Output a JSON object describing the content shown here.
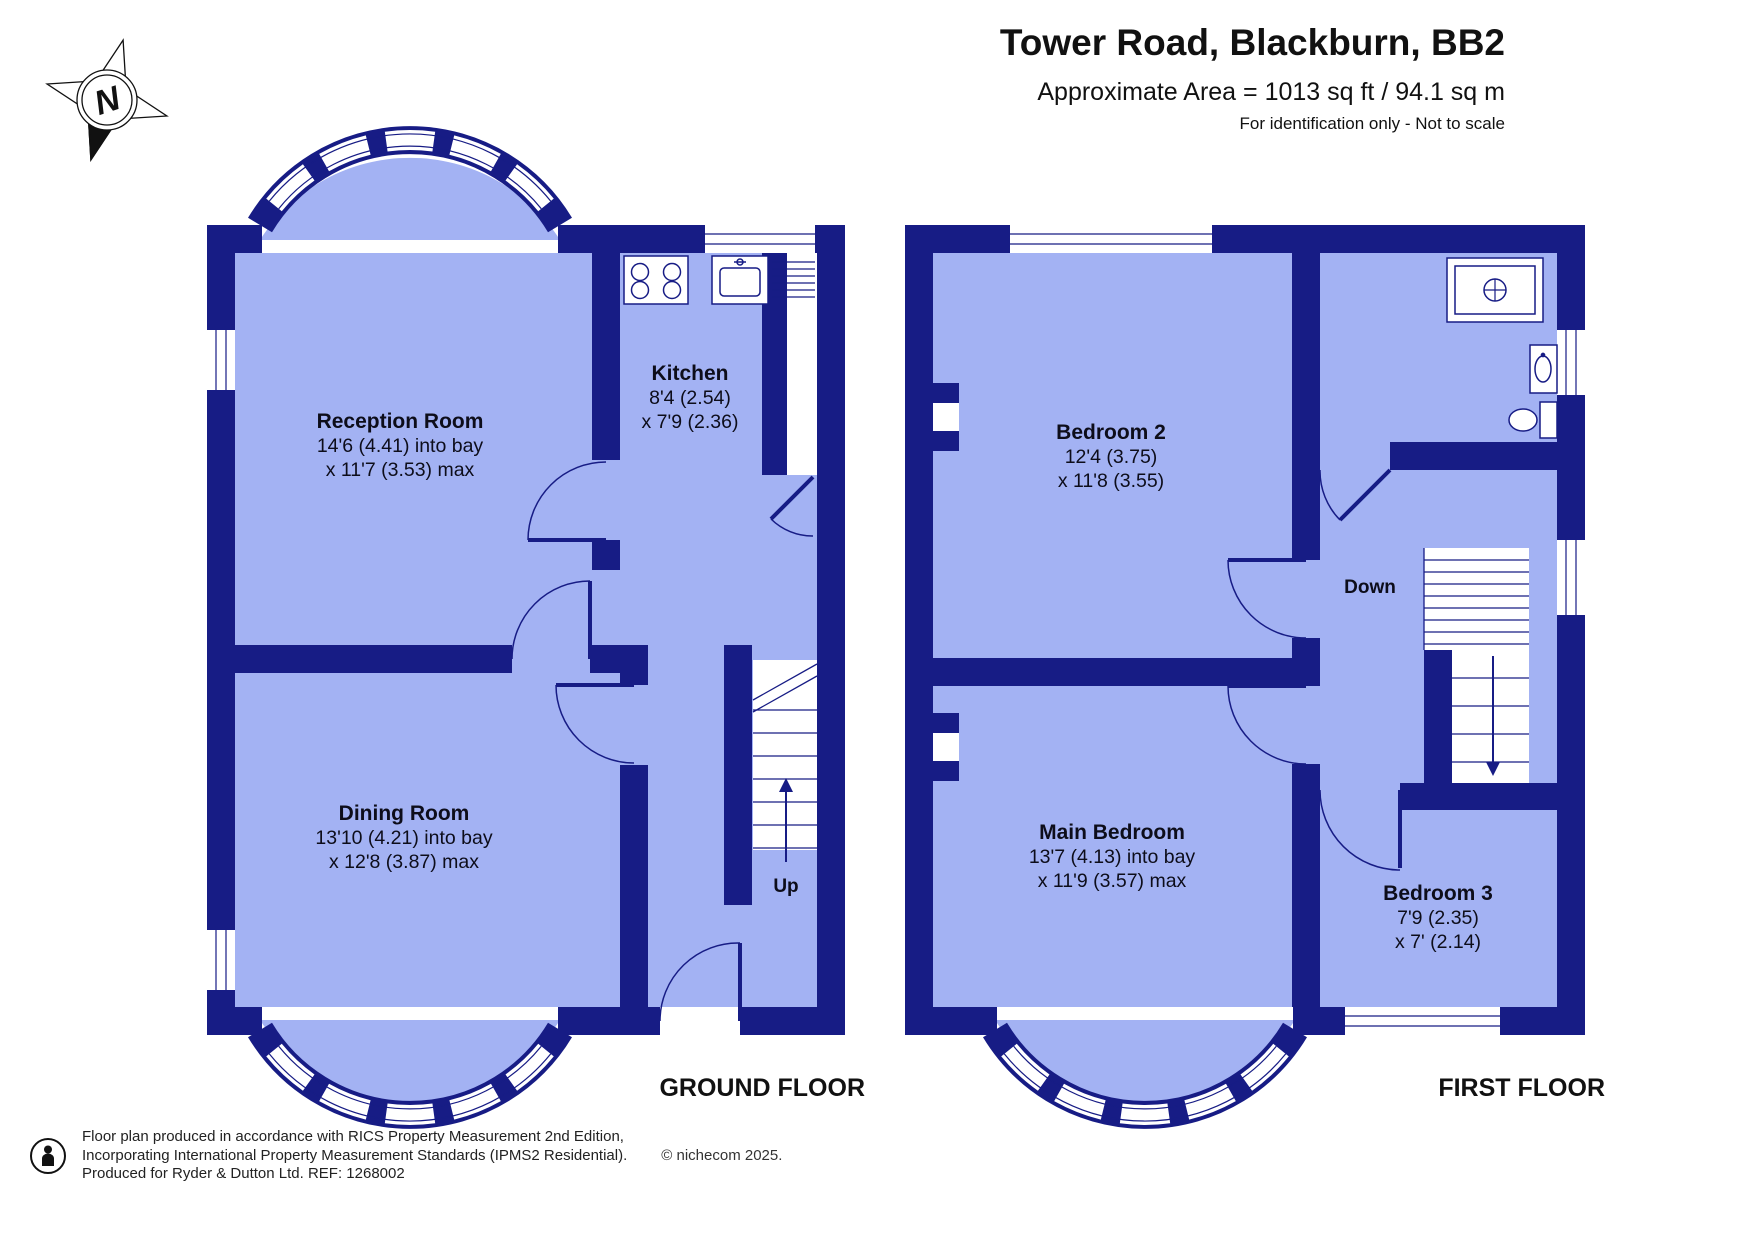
{
  "header": {
    "title": "Tower Road, Blackburn, BB2",
    "area": "Approximate Area = 1013 sq ft / 94.1 sq m",
    "note": "For identification only - Not to scale"
  },
  "compass": {
    "label": "N"
  },
  "colors": {
    "wall": "#171C85",
    "floor": "#A3B2F3",
    "line": "#171C85",
    "text": "#111111"
  },
  "ground_floor": {
    "label": "GROUND FLOOR",
    "stairs_label": "Up",
    "rooms": {
      "reception": {
        "name": "Reception Room",
        "dim1": "14'6 (4.41) into bay",
        "dim2": "x 11'7 (3.53) max"
      },
      "kitchen": {
        "name": "Kitchen",
        "dim1": "8'4 (2.54)",
        "dim2": "x 7'9 (2.36)"
      },
      "dining": {
        "name": "Dining Room",
        "dim1": "13'10 (4.21) into bay",
        "dim2": "x 12'8 (3.87) max"
      }
    }
  },
  "first_floor": {
    "label": "FIRST FLOOR",
    "stairs_label": "Down",
    "rooms": {
      "bedroom2": {
        "name": "Bedroom 2",
        "dim1": "12'4 (3.75)",
        "dim2": "x 11'8 (3.55)"
      },
      "main_bedroom": {
        "name": "Main Bedroom",
        "dim1": "13'7 (4.13) into bay",
        "dim2": "x 11'9 (3.57) max"
      },
      "bedroom3": {
        "name": "Bedroom 3",
        "dim1": "7'9 (2.35)",
        "dim2": "x 7' (2.14)"
      }
    }
  },
  "footer": {
    "line1": "Floor plan produced in accordance with RICS Property Measurement 2nd Edition,",
    "line2": "Incorporating International Property Measurement Standards (IPMS2 Residential).",
    "copyright": "© nichecom 2025.",
    "line3": "Produced for Ryder & Dutton Ltd.   REF:  1268002"
  }
}
